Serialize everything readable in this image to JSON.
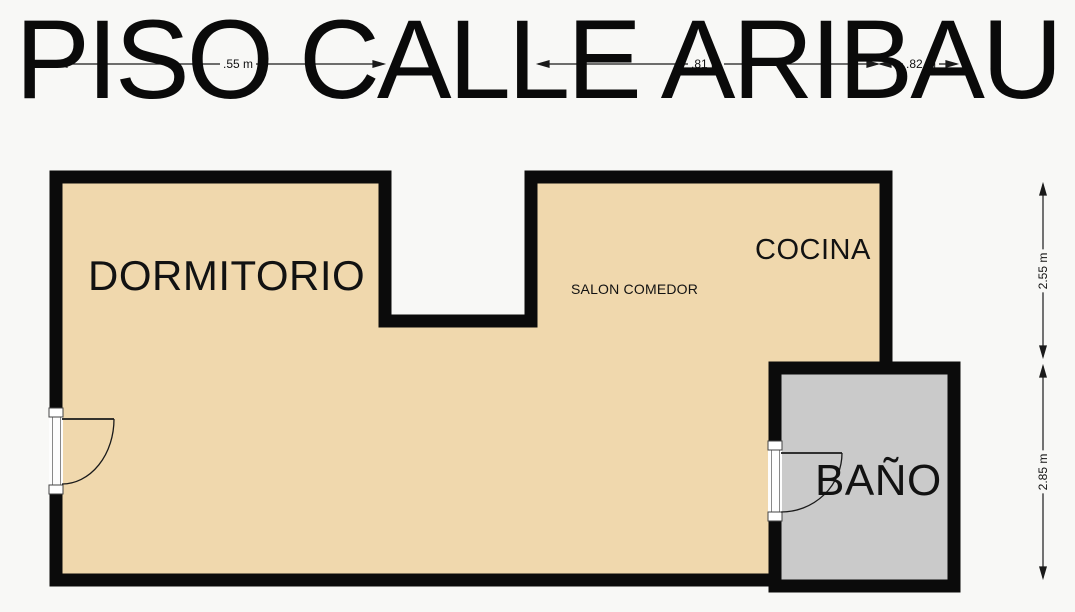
{
  "title": "PISO CALLE ARIBAU",
  "rooms": {
    "dormitorio": "DORMITORIO",
    "salon_comedor": "SALON COMEDOR",
    "cocina": "COCINA",
    "bano": "BAÑO"
  },
  "dimensions": {
    "top_left": ".55 m",
    "top_middle": ".81 m",
    "top_right": ".82 m",
    "right_upper": "2.55 m",
    "right_lower": "2.85 m"
  },
  "colors": {
    "background": "#F8F8F6",
    "floor": "#F0D8AD",
    "bathroom_floor": "#CACACA",
    "wall": "#0B0B0B",
    "text": "#0B0B0B"
  }
}
